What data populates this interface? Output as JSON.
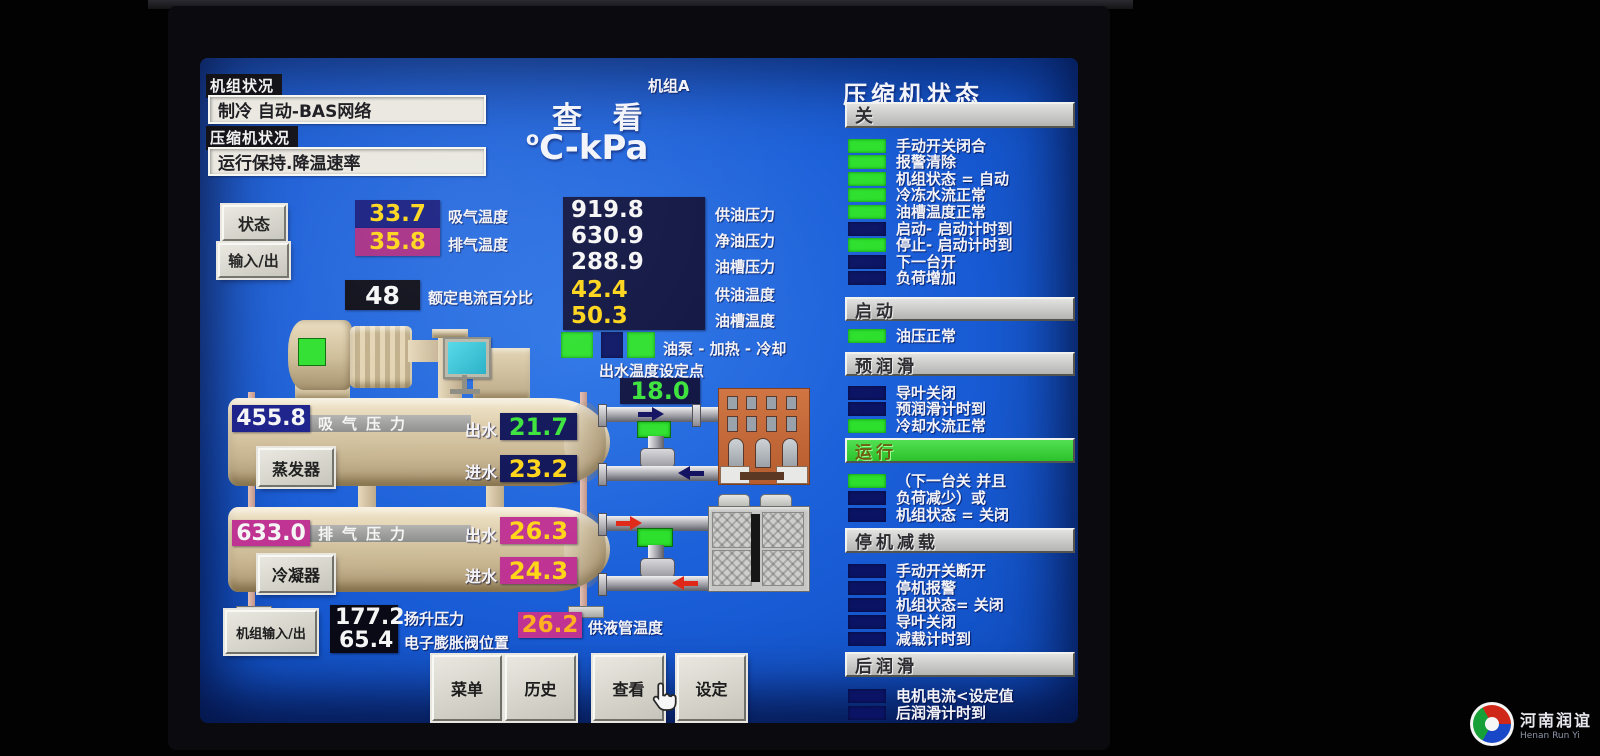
{
  "header": {
    "unit_tag": "机组A",
    "view_title": "查 看",
    "units_sup": "o",
    "units_main": "C-kPa",
    "unit_status_label": "机组状况",
    "unit_status_value": "制冷  自动-BAS网络",
    "comp_status_label": "压缩机状况",
    "comp_status_value": "运行保持.降温速率"
  },
  "left_buttons": {
    "status": "状态",
    "io": "输入/出",
    "unit_io": "机组输入/出"
  },
  "readings": {
    "suction_temp": {
      "value": "33.7",
      "label": "吸气温度"
    },
    "discharge_temp": {
      "value": "35.8",
      "label": "排气温度"
    },
    "fla_percent": {
      "value": "48",
      "label": "额定电流百分比"
    },
    "oil_rows": [
      {
        "value": "919.8",
        "label": "供油压力"
      },
      {
        "value": "630.9",
        "label": "净油压力"
      },
      {
        "value": "288.9",
        "label": "油槽压力"
      },
      {
        "value": "42.4",
        "label": "供油温度"
      },
      {
        "value": "50.3",
        "label": "油槽温度"
      }
    ],
    "pump_row": {
      "label": "油泵 - 加热 - 冷却",
      "ind": [
        true,
        false,
        true
      ]
    },
    "setpoint": {
      "label": "出水温度设定点",
      "value": "18.0"
    },
    "lift_pressure": {
      "value": "177.2",
      "label": "扬升压力"
    },
    "eev_position": {
      "value": "65.4",
      "label": "电子膨胀阀位置"
    },
    "liquid_line_temp": {
      "value": "26.2",
      "label": "供液管温度"
    }
  },
  "evaporator": {
    "pressure": "455.8",
    "pressure_label": "吸气压力",
    "button": "蒸发器",
    "out_label": "出水",
    "out_value": "21.7",
    "in_label": "进水",
    "in_value": "23.2"
  },
  "condenser": {
    "pressure": "633.0",
    "pressure_label": "排气压力",
    "button": "冷凝器",
    "out_label": "出水",
    "out_value": "26.3",
    "in_label": "进水",
    "in_value": "24.3"
  },
  "menu_buttons": [
    "菜单",
    "历史",
    "查看",
    "设定"
  ],
  "panel": {
    "title": "压缩机状态",
    "state_value": "关",
    "groups": [
      {
        "items": [
          {
            "label": "手动开关闭合",
            "on": true
          },
          {
            "label": "报警清除",
            "on": true
          },
          {
            "label": "机组状态 =  自动",
            "on": true
          },
          {
            "label": "冷冻水流正常",
            "on": true
          },
          {
            "label": "油槽温度正常",
            "on": true
          },
          {
            "label": "启动- 启动计时到",
            "on": false
          },
          {
            "label": "停止- 启动计时到",
            "on": true
          },
          {
            "label": "下一台开",
            "on": false
          },
          {
            "label": "负荷增加",
            "on": false
          }
        ]
      },
      {
        "header": "启动",
        "active": false,
        "items": [
          {
            "label": "油压正常",
            "on": true
          }
        ]
      },
      {
        "header": "预润滑",
        "active": false,
        "items": [
          {
            "label": "导叶关闭",
            "on": false
          },
          {
            "label": "预润滑计时到",
            "on": false
          },
          {
            "label": "冷却水流正常",
            "on": true
          }
        ]
      },
      {
        "header": "运行",
        "active": true,
        "items": [
          {
            "label": "（下一台关 并且",
            "on": true
          },
          {
            "label": "负荷减少）或",
            "on": false
          },
          {
            "label": "机组状态 =  关闭",
            "on": false
          }
        ]
      },
      {
        "header": "停机减载",
        "active": false,
        "items": [
          {
            "label": "手动开关断开",
            "on": false
          },
          {
            "label": "停机报警",
            "on": false
          },
          {
            "label": "机组状态= 关闭",
            "on": false
          },
          {
            "label": "导叶关闭",
            "on": false
          },
          {
            "label": "减载计时到",
            "on": false
          }
        ]
      },
      {
        "header": "后润滑",
        "active": false,
        "items": [
          {
            "label": "电机电流<设定值",
            "on": false
          },
          {
            "label": "后润滑计时到",
            "on": false
          }
        ]
      }
    ]
  },
  "watermark": {
    "cn": "河南润谊",
    "en": "Henan Run Yi"
  },
  "colors": {
    "screen_blue": "#1a5ed8",
    "indicator_green": "#2de02d",
    "navy_box": "#131a7e",
    "magenta_box": "#bf3392",
    "value_yellow": "#ffd517",
    "value_green": "#3ae23a",
    "vessel_tan": "#dccca9",
    "button_gray": "#d8d6cc"
  }
}
